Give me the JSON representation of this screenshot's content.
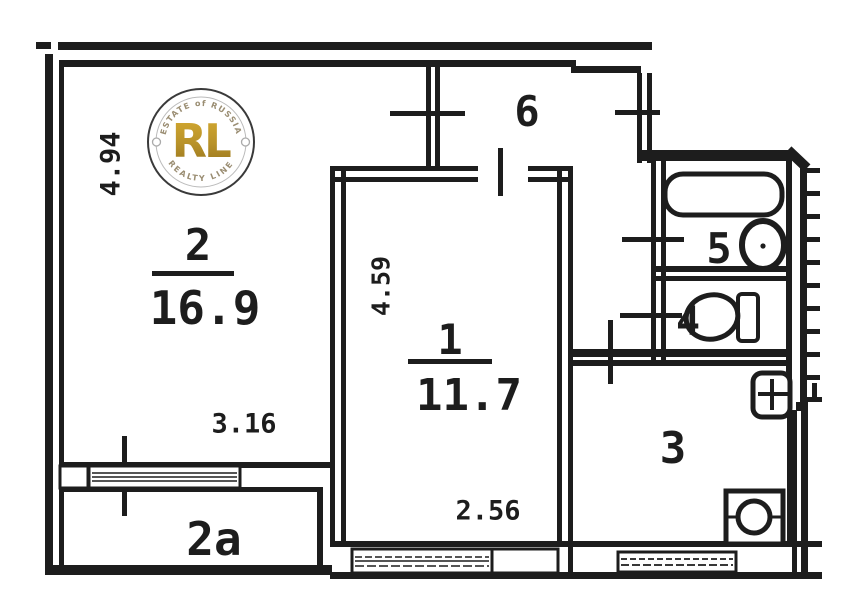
{
  "plan": {
    "rooms": {
      "living": {
        "number": "2",
        "area": "16.9"
      },
      "bedroom": {
        "number": "1",
        "area": "11.7"
      },
      "hall": {
        "number": "6"
      },
      "bath": {
        "number": "5"
      },
      "wc": {
        "number": "4"
      },
      "kitchen": {
        "number": "3"
      },
      "balcony": {
        "number": "2a"
      }
    },
    "dimensions": {
      "living_height": "4.94",
      "living_width": "3.16",
      "bedroom_height": "4.59",
      "bedroom_width": "2.56"
    },
    "colors": {
      "ink": "#1d1d1d",
      "gold": "#b8922a",
      "arc_text": "#9a8d72"
    }
  },
  "watermark": {
    "initials": "RL",
    "arc_top": "ESTATE of RUSSIA",
    "arc_bottom": "REALTY LINE"
  }
}
